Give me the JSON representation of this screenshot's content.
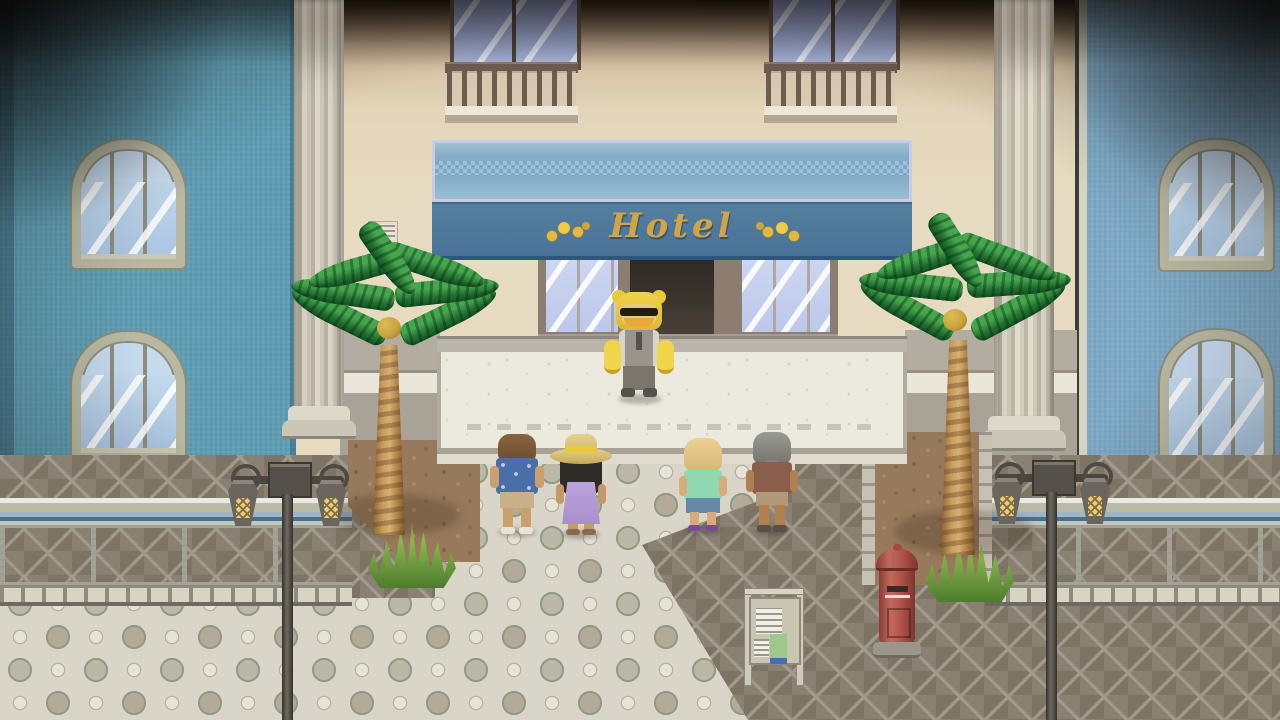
{
  "scene": {
    "title": "Hotel Entrance",
    "sign": {
      "label": "Hotel"
    },
    "characters": [
      {
        "id": "bear-mascot-doorman",
        "desc": "Doorman in yellow bear costume with sunglasses, moustache and grey vest standing at the hotel entrance"
      },
      {
        "id": "tourist-blue-shirt",
        "desc": "Brown-haired tourist in blue patterned shirt and tan shorts"
      },
      {
        "id": "tourist-sun-hat",
        "desc": "Woman wearing a straw sun hat with yellow ribbon and a lavender dress"
      },
      {
        "id": "tourist-teal-shirt",
        "desc": "Blonde tourist in teal shirt and blue shorts with purple flip-flops"
      },
      {
        "id": "tourist-grey-hair",
        "desc": "Grey-haired tourist in brown shirt and khaki shorts"
      }
    ],
    "objects": [
      {
        "id": "hotel-awning",
        "desc": "Blue awning with gold Hotel lettering and gold laurel ornaments"
      },
      {
        "id": "hotel-doorway",
        "desc": "Open doorway flanked by glass storefront windows"
      },
      {
        "id": "palm-tree-left",
        "desc": "Palm tree with coconut on left dirt bed"
      },
      {
        "id": "palm-tree-right",
        "desc": "Palm tree with coconut on right dirt bed"
      },
      {
        "id": "street-lamp-left",
        "desc": "Ornate twin-lantern street lamp on left balustrade"
      },
      {
        "id": "street-lamp-right",
        "desc": "Ornate twin-lantern street lamp on right balustrade"
      },
      {
        "id": "red-postbox",
        "desc": "Red cylindrical post box on stone base"
      },
      {
        "id": "noticeboard",
        "desc": "Notice board with pinned papers"
      },
      {
        "id": "wall-plaque",
        "desc": "Small plaque on facade wall"
      }
    ]
  },
  "palette": {
    "sign-gold": "#d2a445",
    "awning-light": "#8ab0c8",
    "awning-dark": "#4a7298",
    "wall-left-blue": "#5f9eb4",
    "wall-right-blue": "#7da9c6",
    "facade-cream": "#e6dabf",
    "postbox-red": "#b2544c",
    "palm-green": "#2f8f3f",
    "dirt-brown": "#97795b"
  }
}
